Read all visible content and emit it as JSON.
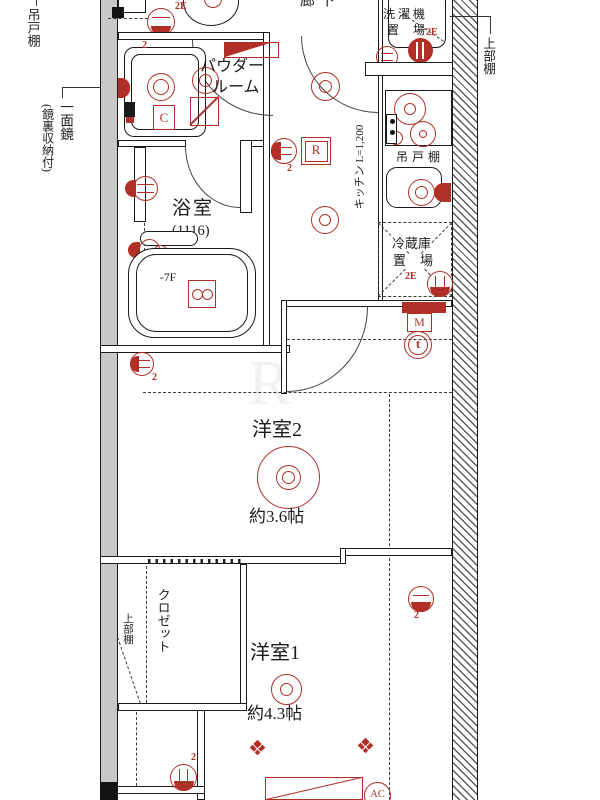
{
  "labels": {
    "western2": "洋室2",
    "western2_size": "約3.6帖",
    "western1": "洋室1",
    "western1_size": "約4.3帖",
    "bath": "浴室",
    "bath_size": "(1116)",
    "bath_floor": "-7F",
    "powder_line1": "パウダー",
    "powder_line2": "ルーム",
    "kitchen": "キッチン L=1,200",
    "cupboard": "吊戸棚",
    "fridge_line1": "冷蔵庫",
    "fridge_line2": "置場",
    "laundry_line1": "洗濯機",
    "laundry_line2": "置場",
    "hallway": "廊下",
    "closet": "クロゼット",
    "closet_shelf": "上部棚",
    "margin_hanging_cupboard": "吊戸棚",
    "margin_mirror": "一面鏡",
    "margin_mirror_sub": "(鏡裏収納付)",
    "margin_right_shelf": "上部棚",
    "sym_r": "R",
    "sym_c": "C",
    "sym_m": "M",
    "sym_ac": "AC",
    "sym_intercom": "t",
    "tag_2e": "2E",
    "tag_2": "2",
    "watermark": "R"
  },
  "colors": {
    "accent_red": "#b03028",
    "wall_gray": "#c9c7c7",
    "line": "#1a1a1a"
  }
}
